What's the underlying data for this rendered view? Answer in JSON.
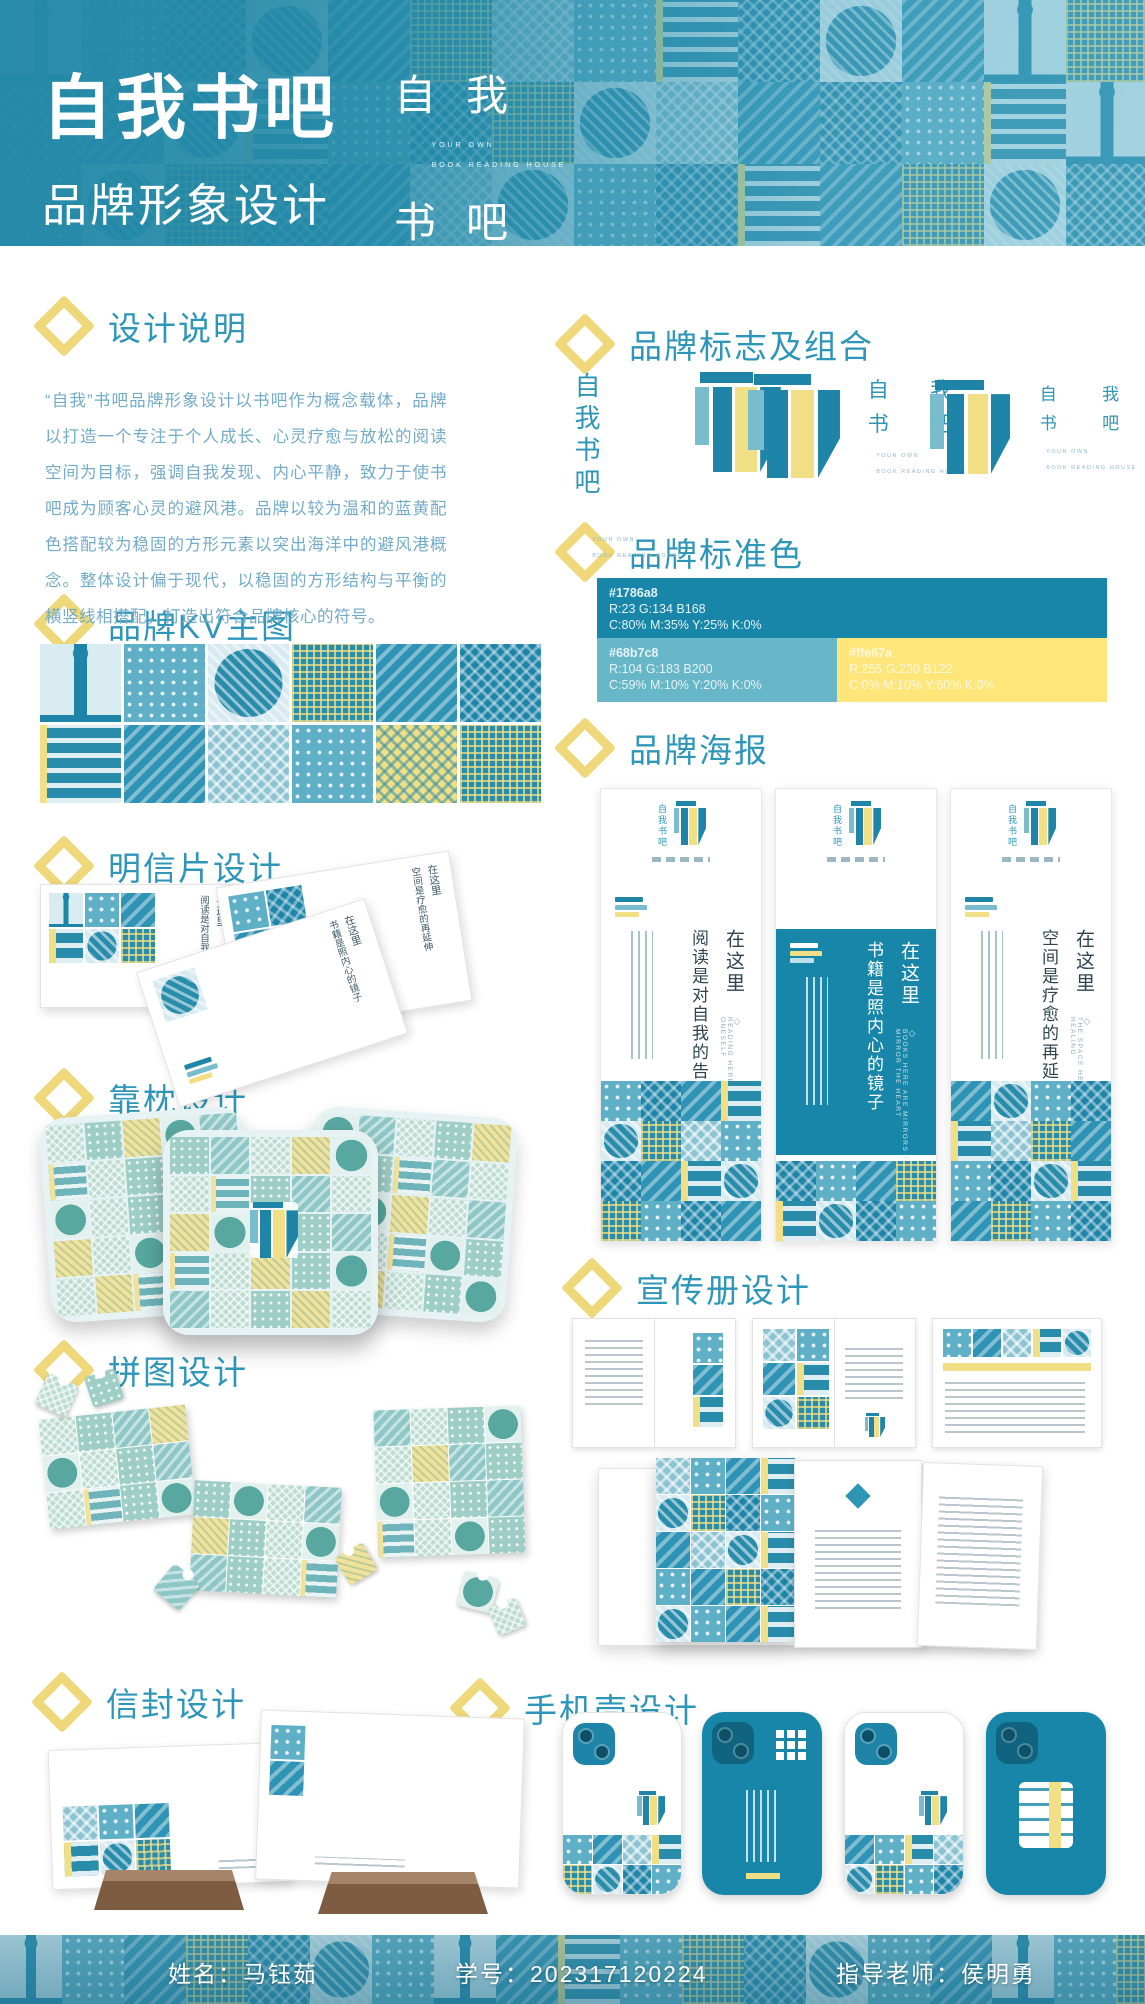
{
  "brand": {
    "name_vertical": "自我书吧",
    "chars": [
      "自",
      "我",
      "书",
      "吧"
    ],
    "en1": "YOUR OWN",
    "en2": "BOOK READING HOUSE"
  },
  "header": {
    "title": "自我书吧",
    "subtitle": "品牌形象设计"
  },
  "sections": {
    "design_note": {
      "title": "设计说明",
      "body": "“自我”书吧品牌形象设计以书吧作为概念载体，品牌以打造一个专注于个人成长、心灵疗愈与放松的阅读空间为目标，强调自我发现、内心平静，致力于使书吧成为顾客心灵的避风港。品牌以较为温和的蓝黄配色搭配较为稳固的方形元素以突出海洋中的避风港概念。整体设计偏于现代，以稳固的方形结构与平衡的横竖线相搭配，打造出符合品牌核心的符号。"
    },
    "kv": {
      "title": "品牌KV主图"
    },
    "postcard": {
      "title": "明信片设计",
      "cards": [
        {
          "line1": "在这里",
          "line2": "阅读是对自我的告白"
        },
        {
          "line1": "在这里",
          "line2": "空间是疗愈的再延伸"
        },
        {
          "line1": "在这里",
          "line2": "书籍是照内心的镜子"
        }
      ]
    },
    "pillow": {
      "title": "靠枕设计"
    },
    "puzzle": {
      "title": "拼图设计"
    },
    "envelope": {
      "title": "信封设计"
    },
    "logo_combo": {
      "title": "品牌标志及组合"
    },
    "colors": {
      "title": "品牌标准色",
      "swatches": [
        {
          "hex": "#1786a8",
          "rgb": "R:23  G:134  B168",
          "cmyk": "C:80%  M:35%  Y:25%  K:0%"
        },
        {
          "hex": "#68b7c8",
          "rgb": "R:104  G:183  B200",
          "cmyk": "C:59%  M:10%  Y:20%  K:0%"
        },
        {
          "hex": "#ffe67a",
          "rgb": "R:255  G:230  B122",
          "cmyk": "C:0%  M:10%  Y:60%  K:0%"
        }
      ]
    },
    "poster": {
      "title": "品牌海报",
      "diamond": "◇",
      "items": [
        {
          "line1": "在这里",
          "line2": "阅读是对自我的告白",
          "en": "READING HERE IS A CONFESSION TO ONESELF"
        },
        {
          "line1": "在这里",
          "line2": "书籍是照内心的镜子",
          "en": "BOOKS HERE ARE MIRRORS THAT MIRROR THE HEART"
        },
        {
          "line1": "在这里",
          "line2": "空间是疗愈的再延伸",
          "en": "THE SPACE HERE IS AN EXTENSION OF HEALING"
        }
      ]
    },
    "brochure": {
      "title": "宣传册设计"
    },
    "phonecase": {
      "title": "手机壳设计"
    }
  },
  "footer": {
    "name_label": "姓名：",
    "name": "马钰茹",
    "id_label": "学号：",
    "id": "202317120224",
    "teacher_label": "指导老师：",
    "teacher": "侯明勇"
  },
  "palette": {
    "dark_teal": "#1786a8",
    "light_teal": "#68b7c8",
    "yellow": "#ffe67a"
  }
}
